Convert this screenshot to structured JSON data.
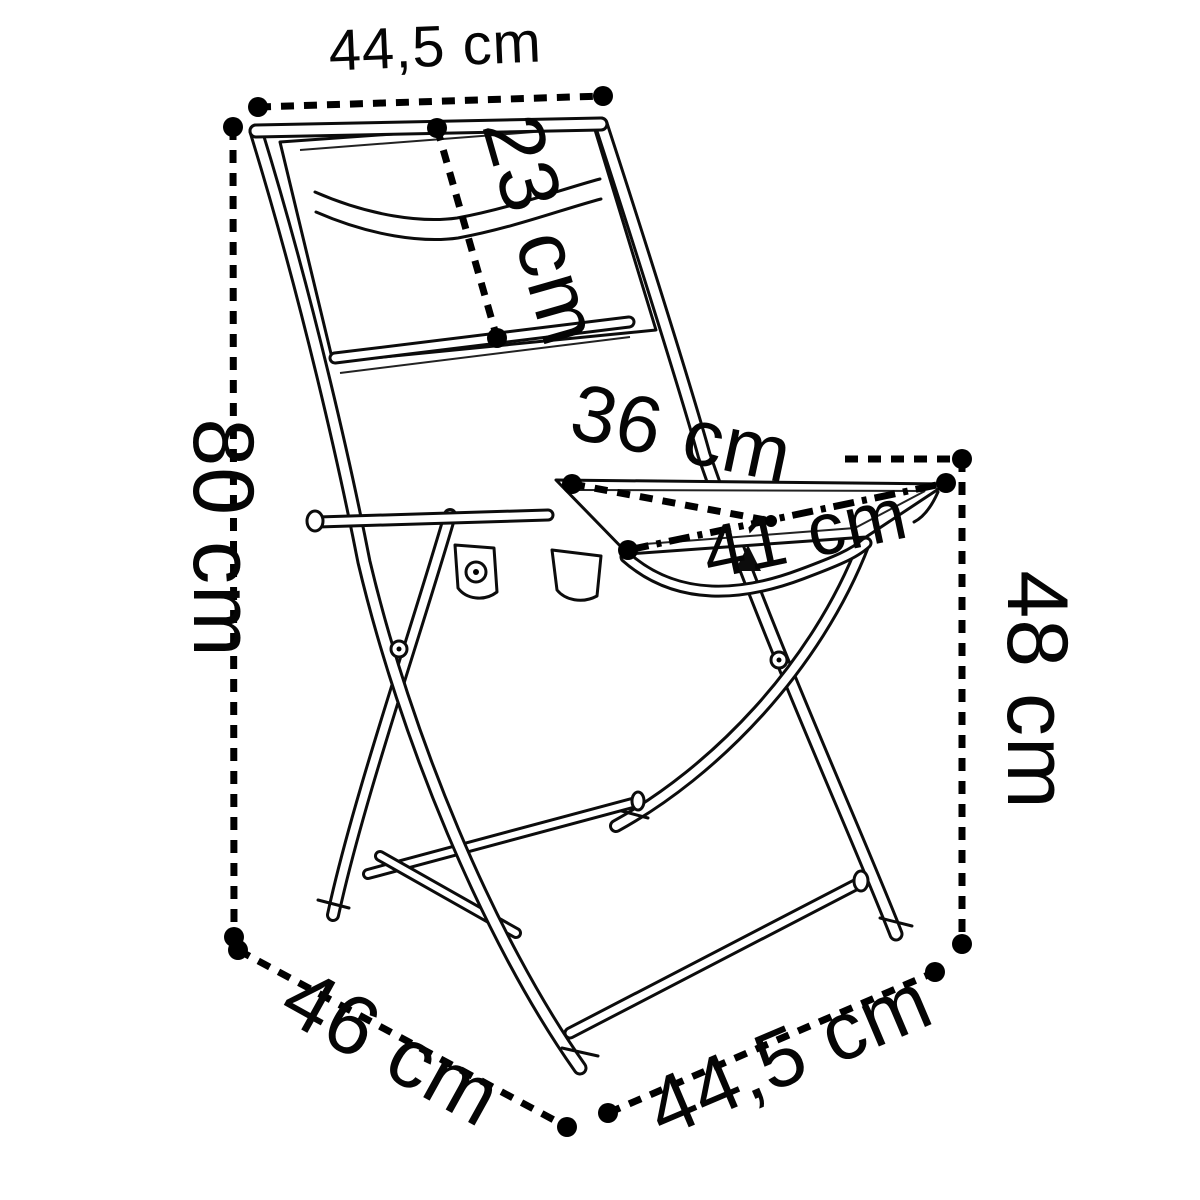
{
  "diagram": {
    "kind": "product-dimension-diagram",
    "subject": "folding-chair",
    "unit": "cm",
    "line_color": "#000000",
    "background_color": "#ffffff"
  },
  "dimensions": [
    {
      "id": "backrest-top-width",
      "label": "44,5 cm",
      "value": 44.5,
      "unit": "cm"
    },
    {
      "id": "backrest-height",
      "label": "23 cm",
      "value": 23,
      "unit": "cm"
    },
    {
      "id": "overall-height",
      "label": "80 cm",
      "value": 80,
      "unit": "cm"
    },
    {
      "id": "seat-depth",
      "label": "36 cm",
      "value": 36,
      "unit": "cm"
    },
    {
      "id": "seat-width",
      "label": "41 cm",
      "value": 41,
      "unit": "cm"
    },
    {
      "id": "seat-height",
      "label": "48 cm",
      "value": 48,
      "unit": "cm"
    },
    {
      "id": "overall-depth",
      "label": "46 cm",
      "value": 46,
      "unit": "cm"
    },
    {
      "id": "overall-width",
      "label": "44,5 cm",
      "value": 44.5,
      "unit": "cm"
    }
  ]
}
